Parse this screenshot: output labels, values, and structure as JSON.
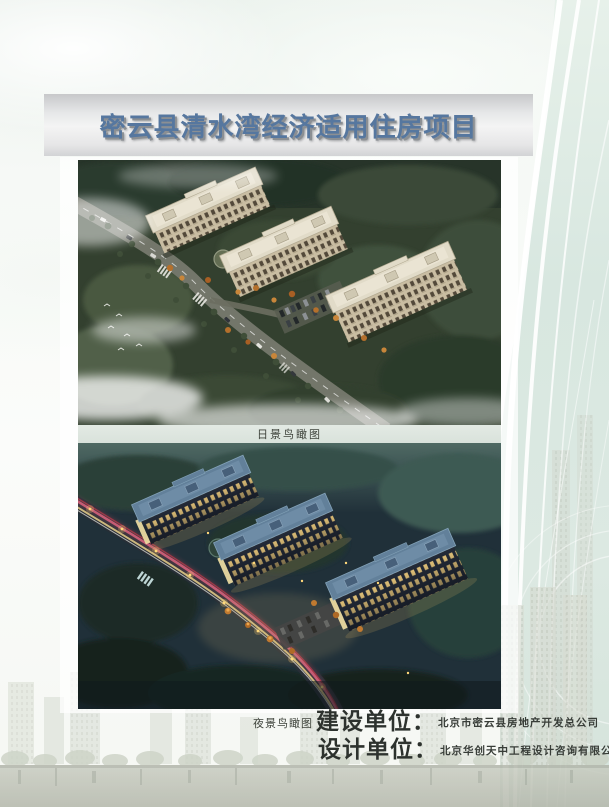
{
  "document": {
    "title": "密云县清水湾经济适用住房项目"
  },
  "figures": {
    "day": {
      "name": "day-aerial-rendering",
      "caption": "日景鸟瞰图"
    },
    "night": {
      "name": "night-aerial-rendering",
      "caption": "夜景鸟瞰图"
    }
  },
  "credits": {
    "rows": [
      {
        "label": "建设单位",
        "colon": "：",
        "company": "北京市密云县房地产开发总公司"
      },
      {
        "label": "设计单位",
        "colon": "：",
        "company": "北京华创天中工程设计咨询有限公司"
      }
    ]
  },
  "colors": {
    "title_text": "#56779f",
    "title_shadow": "#8b8f93",
    "banner_gray": "#e6e7e8",
    "accent_teal_band": "#d9e7e1",
    "caption_strip": "#dde5de",
    "credit_text": "#2d322e"
  }
}
